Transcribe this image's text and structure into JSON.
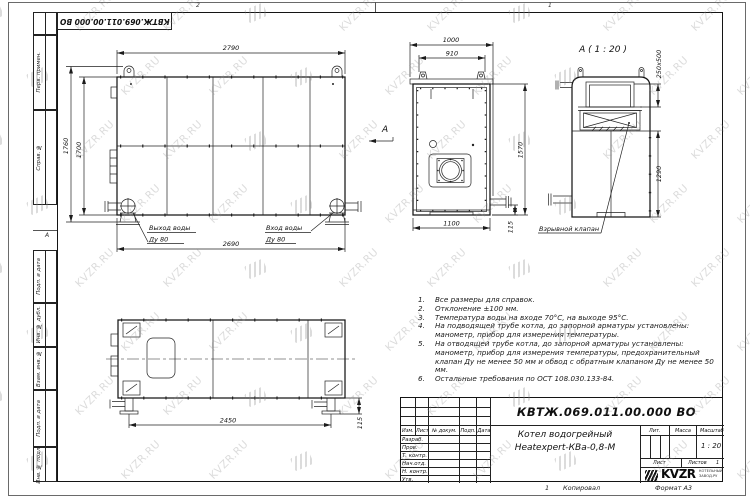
{
  "watermark": {
    "text": "KVZR.RU"
  },
  "sheet": {
    "stamp_number": "КВТЖ.069.011.00.000 ВО",
    "margin_top_cells": [
      "Перв. примен.",
      "Справ. №"
    ],
    "margin_bottom_cells": [
      "Подп. и дата",
      "Инв. № дубл.",
      "Взам. инв. №",
      "Подп. и дата",
      "Инв. № подл."
    ],
    "zone_letter": "А",
    "zone_top_left": "2",
    "zone_top_right": "1",
    "footer_num": "1",
    "footer_copy": "Копировал",
    "footer_format": "Формат А3"
  },
  "side_view": {
    "dim_top": "2790",
    "dim_left_outer": "1760",
    "dim_left_inner": "1700",
    "dim_bottom": "2690",
    "outlet": [
      "Выход воды",
      "Ду 80"
    ],
    "inlet": [
      "Вход воды",
      "Ду 80"
    ]
  },
  "front_view": {
    "dim_top": "1000",
    "dim_top_inner": "910",
    "dim_right": "1570",
    "dim_bottom": "1100",
    "dim_offset": "115",
    "view_mark": "А"
  },
  "detail_view": {
    "title": "А ( 1 : 20 )",
    "dim_opening": "250х500",
    "dim_height": "1290",
    "callout": "Взрывной клапан"
  },
  "plan_view": {
    "dim_bottom": "2450",
    "dim_offset": "115"
  },
  "notes": {
    "items": [
      {
        "num": "1.",
        "text": "Все размеры для справок."
      },
      {
        "num": "2.",
        "text": "Отклонение ±100 мм."
      },
      {
        "num": "3.",
        "text": "Температура воды на входе 70°С, на выходе 95°С."
      },
      {
        "num": "4.",
        "text": "На подводящей трубе котла, до запорной арматуры установлены: манометр, прибор для измерения температуры."
      },
      {
        "num": "5.",
        "text": "На отводящей трубе котла, до запорной арматуры установлены: манометр, прибор для измерения температуры, предохранительный клапан Ду не менее 50 мм и обвод с обратным клапаном Ду не менее 50 мм."
      },
      {
        "num": "6.",
        "text": "Остальные требования по ОСТ 108.030.133-84."
      }
    ]
  },
  "titleblock": {
    "doc_number": "КВТЖ.069.011.00.000 ВО",
    "product_line1": "Котел водогрейный",
    "product_line2": "Heatexpert-КВа-0,8-М",
    "cols": [
      "Изм.",
      "Лист",
      "№ докум.",
      "Подп.",
      "Дата"
    ],
    "rows": [
      "Разраб.",
      "Пров.",
      "Т. контр.",
      "Нач.отд.",
      "Н. контр.",
      "Утв."
    ],
    "lit": "Лит.",
    "mass": "Масса",
    "scale": "Масштаб",
    "scale_value": "1 : 20",
    "sheet": "Лист",
    "sheets": "Листов",
    "sheets_value": "1",
    "logo": "KVZR",
    "logo_sub1": "КОТЕЛЬНЫЙ",
    "logo_sub2": "ЗАВОД.РУ"
  }
}
